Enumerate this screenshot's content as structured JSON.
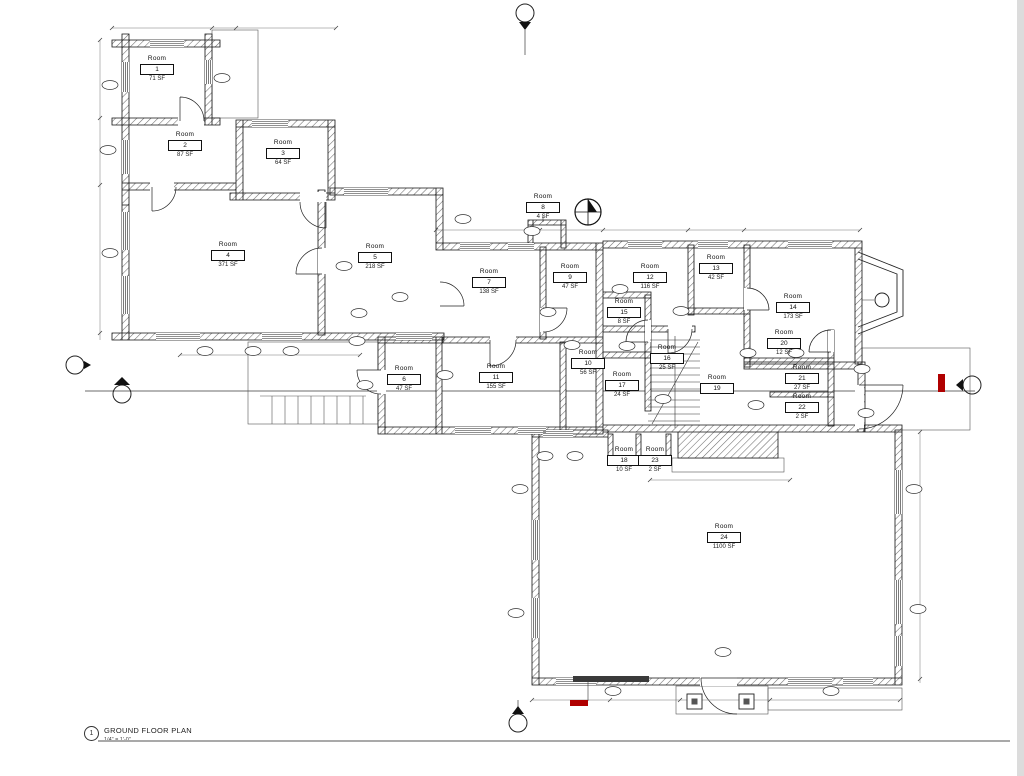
{
  "drawing": {
    "title": "GROUND FLOOR PLAN",
    "scale": "1/4\" = 1'-0\"",
    "detail_number": "1",
    "type": "architectural-floor-plan"
  },
  "colors": {
    "red_accent": "#b00000",
    "line": "#1a1a1a",
    "frame_gray": "#a9a9a9"
  },
  "rooms": [
    {
      "label": "Room",
      "number": "1",
      "area": "71 SF"
    },
    {
      "label": "Room",
      "number": "2",
      "area": "87 SF"
    },
    {
      "label": "Room",
      "number": "3",
      "area": "64 SF"
    },
    {
      "label": "Room",
      "number": "4",
      "area": "371 SF"
    },
    {
      "label": "Room",
      "number": "5",
      "area": "218 SF"
    },
    {
      "label": "Room",
      "number": "6",
      "area": "47 SF"
    },
    {
      "label": "Room",
      "number": "7",
      "area": "138 SF"
    },
    {
      "label": "Room",
      "number": "8",
      "area": "4 SF"
    },
    {
      "label": "Room",
      "number": "9",
      "area": "47 SF"
    },
    {
      "label": "Room",
      "number": "10",
      "area": "56 SF"
    },
    {
      "label": "Room",
      "number": "11",
      "area": "155 SF"
    },
    {
      "label": "Room",
      "number": "12",
      "area": "116 SF"
    },
    {
      "label": "Room",
      "number": "13",
      "area": "42 SF"
    },
    {
      "label": "Room",
      "number": "14",
      "area": "173 SF"
    },
    {
      "label": "Room",
      "number": "15",
      "area": "8 SF"
    },
    {
      "label": "Room",
      "number": "16",
      "area": "25 SF"
    },
    {
      "label": "Room",
      "number": "17",
      "area": "24 SF"
    },
    {
      "label": "Room",
      "number": "18",
      "area": "10 SF"
    },
    {
      "label": "Room",
      "number": "19",
      "area": ""
    },
    {
      "label": "Room",
      "number": "20",
      "area": "12 SF"
    },
    {
      "label": "Room",
      "number": "21",
      "area": "27 SF"
    },
    {
      "label": "Room",
      "number": "22",
      "area": "2 SF"
    },
    {
      "label": "Room",
      "number": "23",
      "area": "2 SF"
    },
    {
      "label": "Room",
      "number": "24",
      "area": "1100 SF"
    }
  ]
}
